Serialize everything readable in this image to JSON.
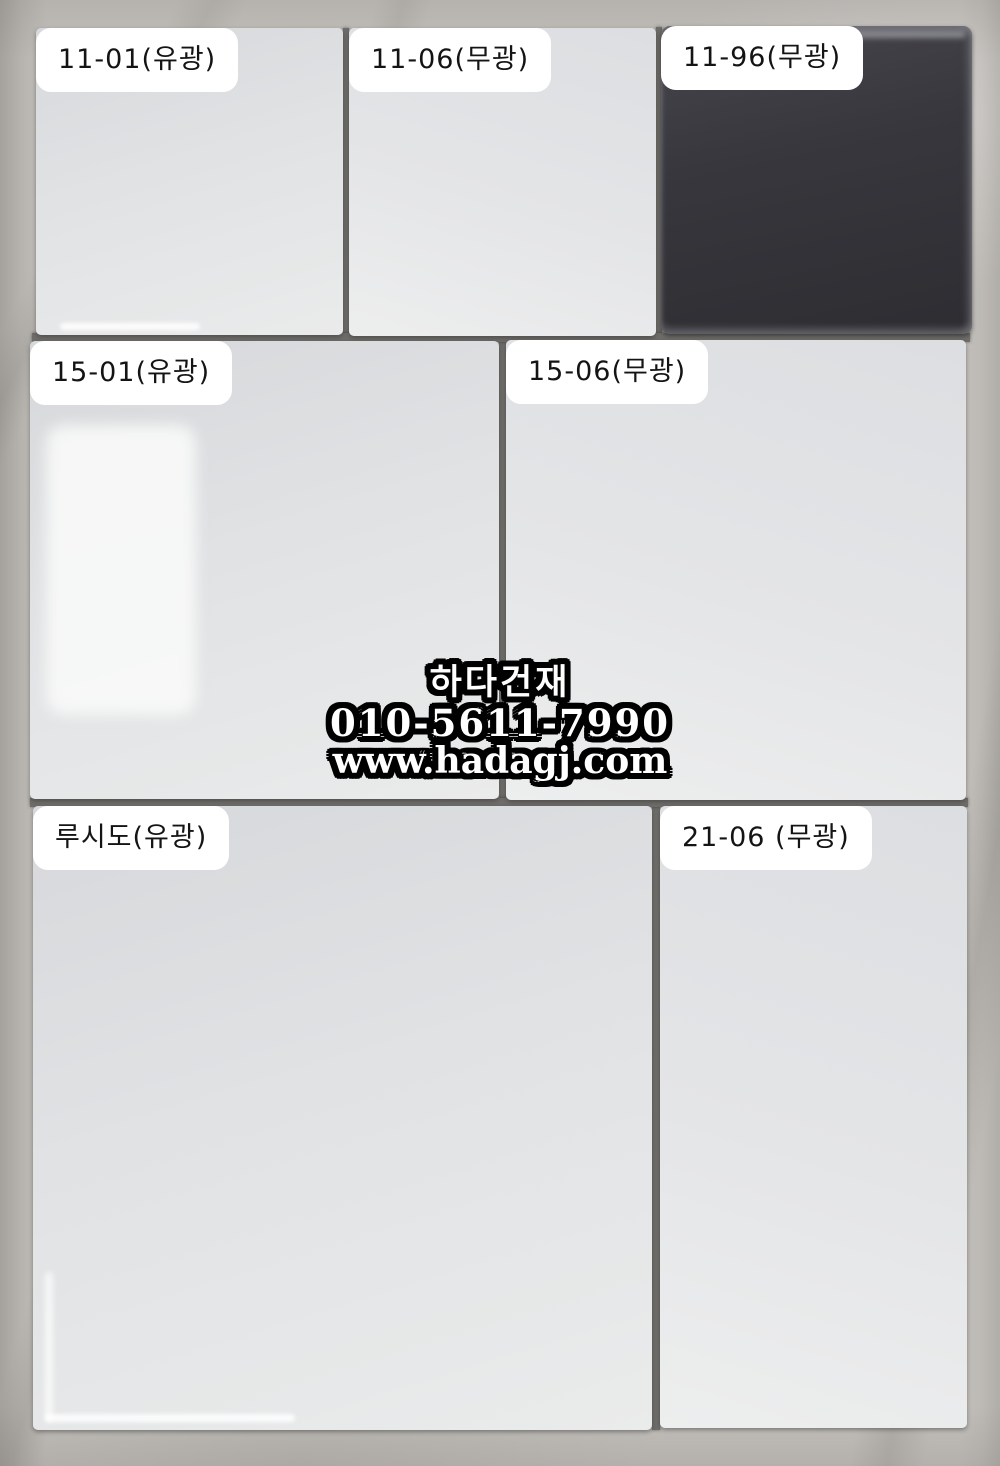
{
  "photo": {
    "description": "Ceramic tile sample board photographed on marble surface",
    "background_color": "#c3c0bc",
    "grout_color": "#6f6d6a"
  },
  "tiles": [
    {
      "label": "11-01(유광)",
      "code": "11-01",
      "finish": "유광",
      "appearance": "white-gloss"
    },
    {
      "label": "11-06(무광)",
      "code": "11-06",
      "finish": "무광",
      "appearance": "white-matte"
    },
    {
      "label": "11-96(무광)",
      "code": "11-96",
      "finish": "무광",
      "appearance": "black-matte",
      "tile_color": "#35353a"
    },
    {
      "label": "15-01(유광)",
      "code": "15-01",
      "finish": "유광",
      "appearance": "white-gloss"
    },
    {
      "label": "15-06(무광)",
      "code": "15-06",
      "finish": "무광",
      "appearance": "white-matte"
    },
    {
      "label": "루시도(유광)",
      "code": "루시도",
      "finish": "유광",
      "appearance": "white-gloss"
    },
    {
      "label": "21-06 (무광)",
      "code": "21-06",
      "finish": "무광",
      "appearance": "white-matte"
    }
  ],
  "label_style": {
    "background": "#ffffff",
    "text_color": "#141414"
  },
  "watermark": {
    "company": "하다건재",
    "phone": "010-5611-7990",
    "website": "www.hadagj.com",
    "text_color": "#ffffff",
    "outline_color": "#000000"
  }
}
